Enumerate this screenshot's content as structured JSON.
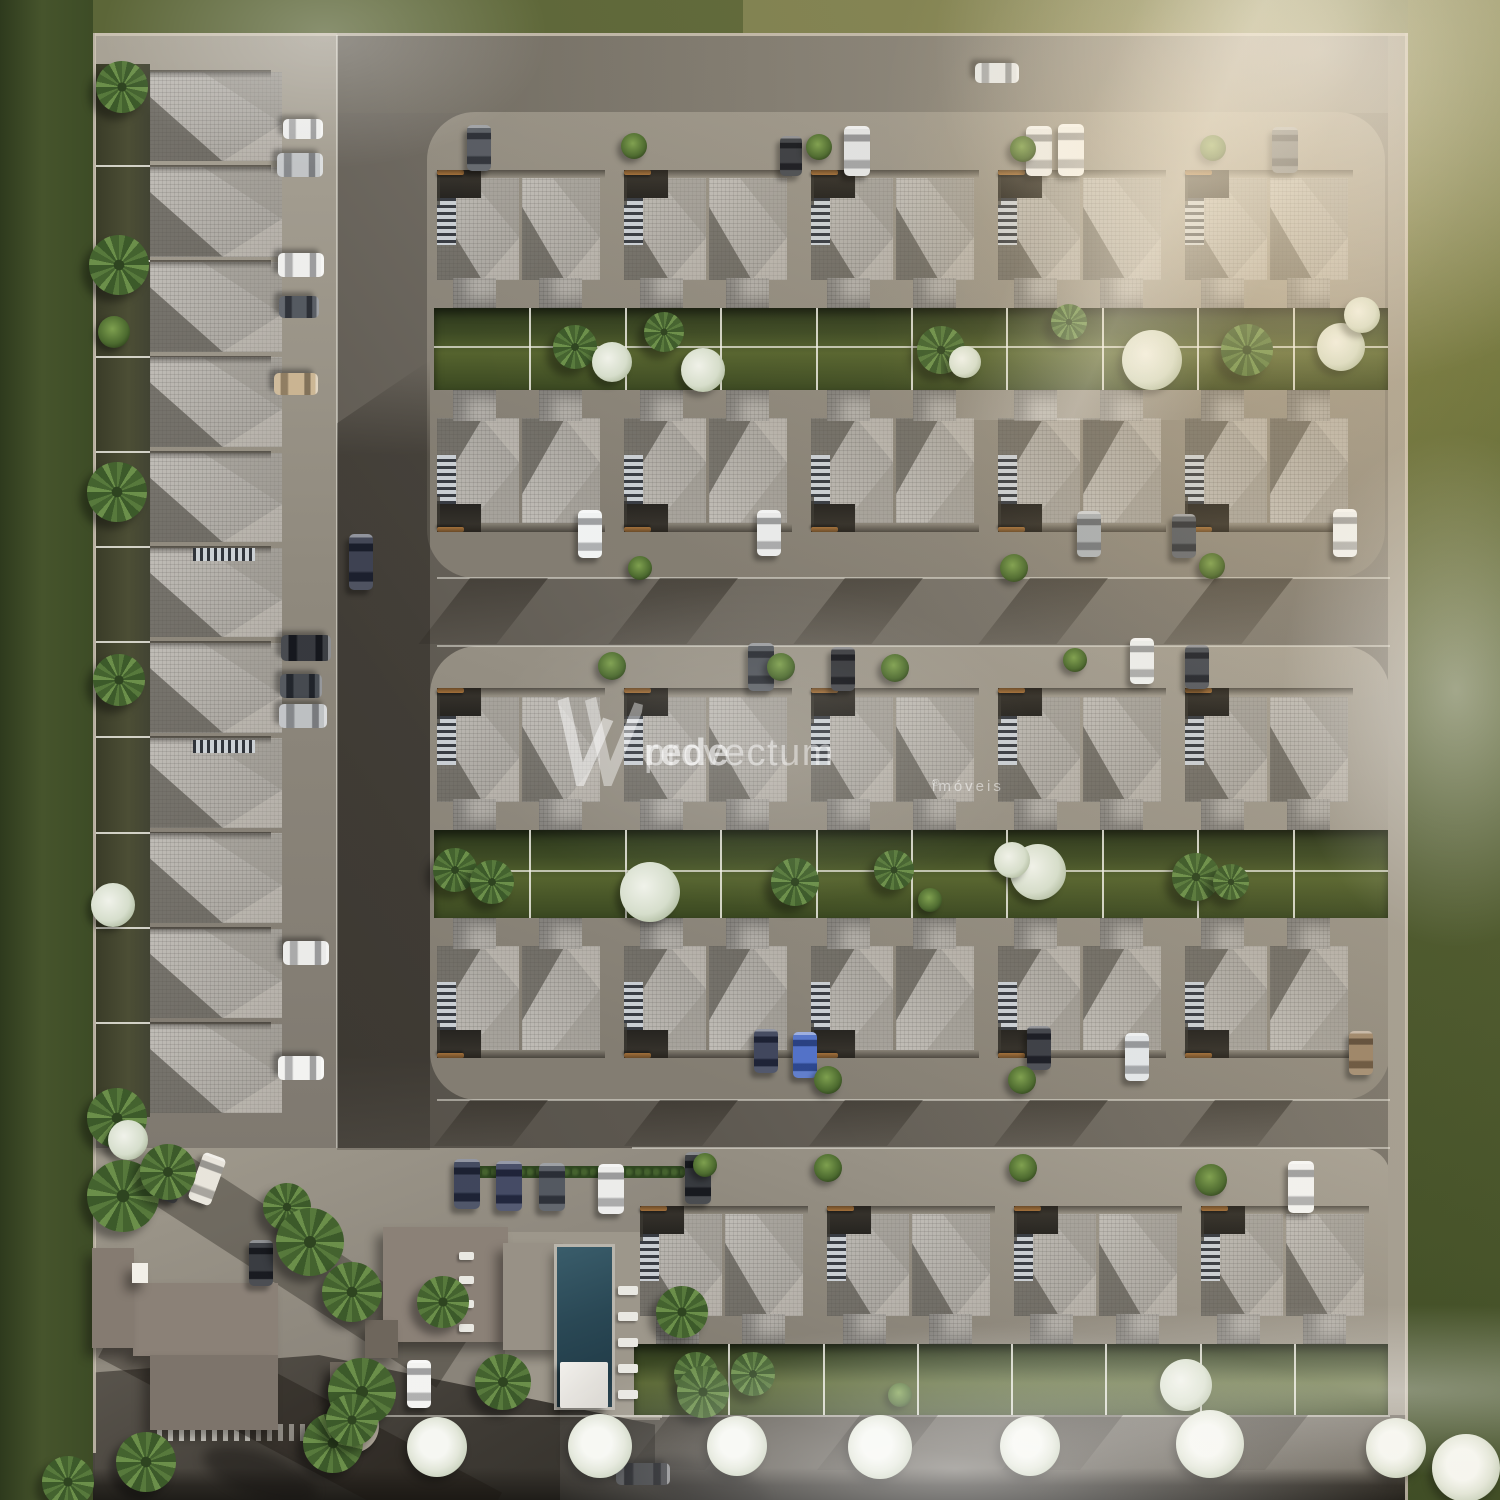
{
  "watermark": {
    "logo": "W",
    "brand_first": "rede",
    "brand_second": "provectum",
    "subtitle": "imóveis",
    "registered": "®",
    "color": "rgba(255,255,255,0.55)"
  },
  "palette": {
    "grass_dark": "#3d4c26",
    "grass_olive": "#7e8050",
    "road": "#5d5850",
    "pavement": "#948e82",
    "roof_tile": "#b6b2ab",
    "roof_facet_dark": "#56524b",
    "hedge_green": "#3d4a24",
    "pool_water": "#2a4855",
    "clubhouse_roof": "#8b8177",
    "bench_wood": "#c28544",
    "fence_white": "#f2f0e8",
    "fog_white": "#ffffff"
  },
  "scene": {
    "house_rows": [
      {
        "id": "row-top-front",
        "x": 437,
        "y": 170,
        "count": 5,
        "unit_w": 187,
        "unit_h": 138,
        "flip": false
      },
      {
        "id": "row-top-back",
        "x": 437,
        "y": 390,
        "count": 5,
        "unit_w": 187,
        "unit_h": 142,
        "flip": true
      },
      {
        "id": "row-mid-front",
        "x": 437,
        "y": 688,
        "count": 5,
        "unit_w": 187,
        "unit_h": 142,
        "flip": false
      },
      {
        "id": "row-mid-back",
        "x": 437,
        "y": 918,
        "count": 5,
        "unit_w": 187,
        "unit_h": 140,
        "flip": true
      },
      {
        "id": "row-bottom",
        "x": 640,
        "y": 1206,
        "count": 4,
        "unit_w": 187,
        "unit_h": 138,
        "flip": false
      }
    ],
    "left_column": {
      "x": 150,
      "y": 70,
      "count": 11,
      "unit_w": 132,
      "unit_h": 95.2,
      "ladders": [
        {
          "x": 193,
          "y": 548
        },
        {
          "x": 193,
          "y": 740
        }
      ]
    },
    "yards": [
      {
        "x": 434,
        "y": 308,
        "w": 954,
        "h": 82,
        "units": 10,
        "midline": true
      },
      {
        "x": 434,
        "y": 830,
        "w": 954,
        "h": 88,
        "units": 10,
        "midline": true
      },
      {
        "x": 634,
        "y": 1344,
        "w": 754,
        "h": 71,
        "units": 8,
        "midline": false
      }
    ],
    "left_yard": {
      "x": 96,
      "y": 64,
      "w": 54,
      "h": 1053
    },
    "cars": [
      {
        "x": 997,
        "y": 73,
        "a": 90,
        "l": 44,
        "w": 20,
        "c": "#dfe2e4"
      },
      {
        "x": 361,
        "y": 562,
        "a": 0,
        "l": 56,
        "w": 24,
        "c": "#23283a"
      },
      {
        "x": 643,
        "y": 1474,
        "a": 90,
        "l": 54,
        "w": 22,
        "c": "#17191d"
      },
      {
        "x": 303,
        "y": 129,
        "a": 90,
        "l": 40,
        "w": 20,
        "c": "#e9e9e7"
      },
      {
        "x": 300,
        "y": 165,
        "a": 90,
        "l": 46,
        "w": 24,
        "c": "#b9bcbe"
      },
      {
        "x": 301,
        "y": 265,
        "a": 90,
        "l": 46,
        "w": 24,
        "c": "#ececea"
      },
      {
        "x": 299,
        "y": 307,
        "a": 90,
        "l": 40,
        "w": 22,
        "c": "#3e434b"
      },
      {
        "x": 296,
        "y": 384,
        "a": 90,
        "l": 44,
        "w": 22,
        "c": "#c3aa83"
      },
      {
        "x": 306,
        "y": 648,
        "a": 90,
        "l": 50,
        "w": 26,
        "c": "#1b1e24"
      },
      {
        "x": 301,
        "y": 686,
        "a": 90,
        "l": 42,
        "w": 24,
        "c": "#2c3138"
      },
      {
        "x": 303,
        "y": 716,
        "a": 90,
        "l": 48,
        "w": 24,
        "c": "#b4b7ba"
      },
      {
        "x": 306,
        "y": 953,
        "a": 90,
        "l": 46,
        "w": 24,
        "c": "#e8e8e6"
      },
      {
        "x": 301,
        "y": 1068,
        "a": 90,
        "l": 46,
        "w": 24,
        "c": "#f0f0ee"
      },
      {
        "x": 479,
        "y": 148,
        "a": 0,
        "l": 46,
        "w": 24,
        "c": "#41464e"
      },
      {
        "x": 791,
        "y": 156,
        "a": 0,
        "l": 40,
        "w": 22,
        "c": "#202329"
      },
      {
        "x": 857,
        "y": 151,
        "a": 0,
        "l": 50,
        "w": 26,
        "c": "#dcdedf"
      },
      {
        "x": 1039,
        "y": 151,
        "a": 0,
        "l": 50,
        "w": 26,
        "c": "#e9e9e7"
      },
      {
        "x": 1071,
        "y": 150,
        "a": 0,
        "l": 52,
        "w": 26,
        "c": "#f1f1ef"
      },
      {
        "x": 1285,
        "y": 150,
        "a": 0,
        "l": 46,
        "w": 26,
        "c": "#54585f"
      },
      {
        "x": 590,
        "y": 534,
        "a": 0,
        "l": 48,
        "w": 24,
        "c": "#eef0f0"
      },
      {
        "x": 769,
        "y": 533,
        "a": 0,
        "l": 46,
        "w": 24,
        "c": "#e6e8e8"
      },
      {
        "x": 1089,
        "y": 534,
        "a": 0,
        "l": 46,
        "w": 24,
        "c": "#9aa0a6"
      },
      {
        "x": 1184,
        "y": 536,
        "a": 0,
        "l": 44,
        "w": 24,
        "c": "#40454d"
      },
      {
        "x": 1345,
        "y": 533,
        "a": 0,
        "l": 48,
        "w": 24,
        "c": "#eceff0"
      },
      {
        "x": 761,
        "y": 667,
        "a": 0,
        "l": 48,
        "w": 26,
        "c": "#383d45"
      },
      {
        "x": 843,
        "y": 669,
        "a": 0,
        "l": 44,
        "w": 24,
        "c": "#17191f"
      },
      {
        "x": 1142,
        "y": 661,
        "a": 0,
        "l": 46,
        "w": 24,
        "c": "#e9ebea"
      },
      {
        "x": 1197,
        "y": 667,
        "a": 0,
        "l": 44,
        "w": 24,
        "c": "#2c313b"
      },
      {
        "x": 766,
        "y": 1051,
        "a": 0,
        "l": 44,
        "w": 24,
        "c": "#272e47"
      },
      {
        "x": 805,
        "y": 1055,
        "a": 0,
        "l": 46,
        "w": 24,
        "c": "#3b5fc0"
      },
      {
        "x": 1039,
        "y": 1048,
        "a": 0,
        "l": 44,
        "w": 24,
        "c": "#21242e"
      },
      {
        "x": 1137,
        "y": 1057,
        "a": 0,
        "l": 48,
        "w": 24,
        "c": "#dde2e6"
      },
      {
        "x": 1361,
        "y": 1053,
        "a": 0,
        "l": 44,
        "w": 24,
        "c": "#8e7353"
      },
      {
        "x": 467,
        "y": 1184,
        "a": 0,
        "l": 50,
        "w": 26,
        "c": "#252d45"
      },
      {
        "x": 509,
        "y": 1186,
        "a": 0,
        "l": 50,
        "w": 26,
        "c": "#2b3250"
      },
      {
        "x": 552,
        "y": 1187,
        "a": 0,
        "l": 48,
        "w": 26,
        "c": "#3c424b"
      },
      {
        "x": 611,
        "y": 1189,
        "a": 0,
        "l": 50,
        "w": 26,
        "c": "#e9e9e7"
      },
      {
        "x": 698,
        "y": 1178,
        "a": 0,
        "l": 52,
        "w": 26,
        "c": "#1d2025"
      },
      {
        "x": 1301,
        "y": 1187,
        "a": 0,
        "l": 52,
        "w": 26,
        "c": "#f0f0ee"
      },
      {
        "x": 173,
        "y": 1177,
        "a": 20,
        "l": 50,
        "w": 24,
        "c": "#16181c"
      },
      {
        "x": 207,
        "y": 1179,
        "a": 20,
        "l": 50,
        "w": 24,
        "c": "#e5e1d6"
      },
      {
        "x": 261,
        "y": 1263,
        "a": 0,
        "l": 46,
        "w": 24,
        "c": "#1f2228"
      },
      {
        "x": 419,
        "y": 1384,
        "a": 0,
        "l": 48,
        "w": 24,
        "c": "#f1f1ef"
      }
    ],
    "trees": [
      {
        "t": "palm",
        "x": 122,
        "y": 87,
        "s": 26
      },
      {
        "t": "palm",
        "x": 119,
        "y": 265,
        "s": 30
      },
      {
        "t": "bush",
        "x": 114,
        "y": 332,
        "s": 16
      },
      {
        "t": "palm",
        "x": 117,
        "y": 492,
        "s": 30
      },
      {
        "t": "palm",
        "x": 119,
        "y": 680,
        "s": 26
      },
      {
        "t": "white",
        "x": 113,
        "y": 905,
        "s": 22
      },
      {
        "t": "palm",
        "x": 117,
        "y": 1118,
        "s": 30
      },
      {
        "t": "white",
        "x": 128,
        "y": 1140,
        "s": 20
      },
      {
        "t": "bush",
        "x": 634,
        "y": 146,
        "s": 13
      },
      {
        "t": "bush",
        "x": 819,
        "y": 147,
        "s": 13
      },
      {
        "t": "bush",
        "x": 1023,
        "y": 149,
        "s": 13
      },
      {
        "t": "bush",
        "x": 1213,
        "y": 148,
        "s": 13
      },
      {
        "t": "palm",
        "x": 575,
        "y": 347,
        "s": 22
      },
      {
        "t": "white",
        "x": 612,
        "y": 362,
        "s": 20
      },
      {
        "t": "palm",
        "x": 664,
        "y": 332,
        "s": 20
      },
      {
        "t": "white",
        "x": 703,
        "y": 370,
        "s": 22
      },
      {
        "t": "palm",
        "x": 941,
        "y": 350,
        "s": 24
      },
      {
        "t": "white",
        "x": 965,
        "y": 362,
        "s": 16
      },
      {
        "t": "palm",
        "x": 1069,
        "y": 322,
        "s": 18
      },
      {
        "t": "white",
        "x": 1152,
        "y": 360,
        "s": 30
      },
      {
        "t": "palm",
        "x": 1247,
        "y": 350,
        "s": 26
      },
      {
        "t": "white",
        "x": 1341,
        "y": 347,
        "s": 24
      },
      {
        "t": "white",
        "x": 1362,
        "y": 315,
        "s": 18
      },
      {
        "t": "bush",
        "x": 640,
        "y": 568,
        "s": 12
      },
      {
        "t": "bush",
        "x": 1014,
        "y": 568,
        "s": 14
      },
      {
        "t": "bush",
        "x": 1212,
        "y": 566,
        "s": 13
      },
      {
        "t": "bush",
        "x": 612,
        "y": 666,
        "s": 14
      },
      {
        "t": "bush",
        "x": 781,
        "y": 667,
        "s": 14
      },
      {
        "t": "bush",
        "x": 895,
        "y": 668,
        "s": 14
      },
      {
        "t": "bush",
        "x": 1075,
        "y": 660,
        "s": 12
      },
      {
        "t": "palm",
        "x": 455,
        "y": 870,
        "s": 22
      },
      {
        "t": "palm",
        "x": 492,
        "y": 882,
        "s": 22
      },
      {
        "t": "white",
        "x": 650,
        "y": 892,
        "s": 30
      },
      {
        "t": "palm",
        "x": 795,
        "y": 882,
        "s": 24
      },
      {
        "t": "palm",
        "x": 894,
        "y": 870,
        "s": 20
      },
      {
        "t": "white",
        "x": 1038,
        "y": 872,
        "s": 28
      },
      {
        "t": "white",
        "x": 1012,
        "y": 860,
        "s": 18
      },
      {
        "t": "palm",
        "x": 1196,
        "y": 877,
        "s": 24
      },
      {
        "t": "palm",
        "x": 1231,
        "y": 882,
        "s": 18
      },
      {
        "t": "bush",
        "x": 930,
        "y": 900,
        "s": 12
      },
      {
        "t": "bush",
        "x": 828,
        "y": 1080,
        "s": 14
      },
      {
        "t": "bush",
        "x": 1022,
        "y": 1080,
        "s": 14
      },
      {
        "t": "bush",
        "x": 705,
        "y": 1165,
        "s": 12
      },
      {
        "t": "bush",
        "x": 828,
        "y": 1168,
        "s": 14
      },
      {
        "t": "bush",
        "x": 1023,
        "y": 1168,
        "s": 14
      },
      {
        "t": "bush",
        "x": 1211,
        "y": 1180,
        "s": 16
      },
      {
        "t": "palm",
        "x": 696,
        "y": 1374,
        "s": 22
      },
      {
        "t": "palm",
        "x": 753,
        "y": 1374,
        "s": 22
      },
      {
        "t": "white",
        "x": 1186,
        "y": 1385,
        "s": 26
      },
      {
        "t": "bush",
        "x": 900,
        "y": 1395,
        "s": 12
      },
      {
        "t": "palm",
        "x": 123,
        "y": 1196,
        "s": 36
      },
      {
        "t": "palm",
        "x": 168,
        "y": 1172,
        "s": 28
      },
      {
        "t": "palm",
        "x": 287,
        "y": 1207,
        "s": 24
      },
      {
        "t": "palm",
        "x": 310,
        "y": 1242,
        "s": 34
      },
      {
        "t": "palm",
        "x": 352,
        "y": 1292,
        "s": 30
      },
      {
        "t": "palm",
        "x": 362,
        "y": 1392,
        "s": 34
      },
      {
        "t": "palm",
        "x": 333,
        "y": 1443,
        "s": 30
      },
      {
        "t": "palm",
        "x": 146,
        "y": 1462,
        "s": 30
      },
      {
        "t": "palm",
        "x": 68,
        "y": 1482,
        "s": 26
      },
      {
        "t": "palm",
        "x": 443,
        "y": 1302,
        "s": 26
      },
      {
        "t": "palm",
        "x": 503,
        "y": 1382,
        "s": 28
      },
      {
        "t": "palm",
        "x": 682,
        "y": 1312,
        "s": 26
      },
      {
        "t": "palm",
        "x": 703,
        "y": 1392,
        "s": 26
      },
      {
        "t": "palm",
        "x": 352,
        "y": 1420,
        "s": 26
      },
      {
        "t": "wtree",
        "x": 437,
        "y": 1447,
        "s": 30
      },
      {
        "t": "wtree",
        "x": 600,
        "y": 1446,
        "s": 32
      },
      {
        "t": "wtree",
        "x": 737,
        "y": 1446,
        "s": 30
      },
      {
        "t": "wtree",
        "x": 880,
        "y": 1447,
        "s": 32
      },
      {
        "t": "wtree",
        "x": 1030,
        "y": 1446,
        "s": 30
      },
      {
        "t": "wtree",
        "x": 1210,
        "y": 1444,
        "s": 34
      },
      {
        "t": "wtree",
        "x": 1396,
        "y": 1448,
        "s": 30
      },
      {
        "t": "wtree",
        "x": 1466,
        "y": 1468,
        "s": 34
      }
    ],
    "hedges": [
      {
        "x": 455,
        "y": 1166,
        "w": 230,
        "h": 12
      }
    ],
    "clubhouse": [
      {
        "x": 383,
        "y": 1227,
        "w": 125,
        "h": 115,
        "c": "#8b8177"
      },
      {
        "x": 503,
        "y": 1243,
        "w": 60,
        "h": 107,
        "c": "#989186"
      },
      {
        "x": 133,
        "y": 1283,
        "w": 145,
        "h": 73,
        "c": "#8b8177"
      },
      {
        "x": 92,
        "y": 1248,
        "w": 42,
        "h": 100,
        "c": "#857b71"
      },
      {
        "x": 150,
        "y": 1355,
        "w": 128,
        "h": 75,
        "c": "#7d746b"
      },
      {
        "x": 132,
        "y": 1263,
        "w": 16,
        "h": 20,
        "c": "#f2efe8"
      },
      {
        "x": 365,
        "y": 1320,
        "w": 33,
        "h": 38,
        "c": "#6e665c"
      },
      {
        "x": 330,
        "y": 1362,
        "w": 36,
        "h": 31,
        "c": "#6e665c"
      }
    ],
    "pool": {
      "x": 557,
      "y": 1247,
      "w": 55,
      "h": 160
    },
    "pergola": {
      "x": 560,
      "y": 1362,
      "w": 48,
      "h": 46
    },
    "loungers": [
      {
        "x": 618,
        "y": 1286,
        "count": 5,
        "dy": 26,
        "w": 20,
        "h": 9
      },
      {
        "x": 459,
        "y": 1252,
        "count": 4,
        "dy": 24,
        "w": 15,
        "h": 8
      }
    ],
    "planter": {
      "x": 352,
      "y": 1426,
      "r": 27
    },
    "crosswalk": {
      "x": 157,
      "y": 1424,
      "w": 178,
      "h": 17
    },
    "shadow_bands": [
      {
        "y": 578,
        "h": 66,
        "xs": [
          470,
          660,
          845,
          1030,
          1215
        ]
      },
      {
        "y": 1100,
        "h": 46,
        "xs": [
          470,
          660,
          845,
          1030,
          1215
        ]
      },
      {
        "y": 1415,
        "h": 55,
        "xs": [
          670,
          860,
          1045,
          1230
        ]
      }
    ]
  }
}
